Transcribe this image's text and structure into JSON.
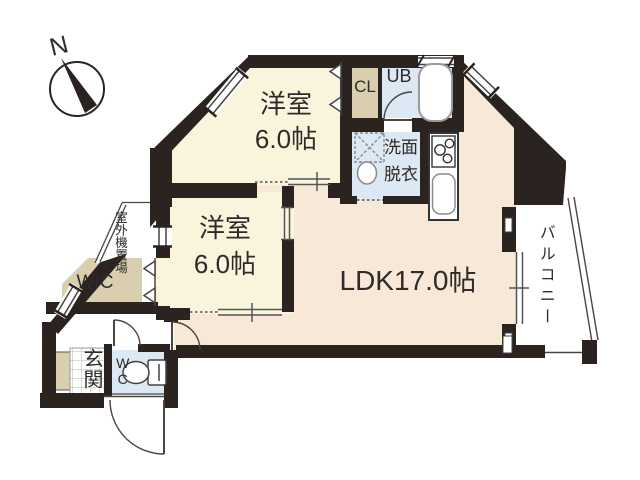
{
  "floor_plan": {
    "compass": {
      "label": "N"
    },
    "bedroom1": {
      "name": "洋室",
      "size": "6.0帖"
    },
    "bedroom2": {
      "name": "洋室",
      "size": "6.0帖"
    },
    "ldk": {
      "label": "LDK17.0帖"
    },
    "balcony": {
      "label": "バルコニー"
    },
    "entrance": {
      "label": "玄関"
    },
    "wic": {
      "label": "WIC"
    },
    "toilet_room": {
      "label": "WC"
    },
    "closet": {
      "label": "CL"
    },
    "unit_bath": {
      "label": "UB"
    },
    "washroom": {
      "label": "洗面脱衣"
    },
    "outdoor_unit": {
      "label": "室外機置場"
    },
    "colors": {
      "wall": "#2b2320",
      "bedroom_cream": "#faf4dc",
      "ldk_peach": "#f7e8d7",
      "wet_blue": "#dce8f3",
      "closet_tan": "#d9cfae"
    }
  }
}
